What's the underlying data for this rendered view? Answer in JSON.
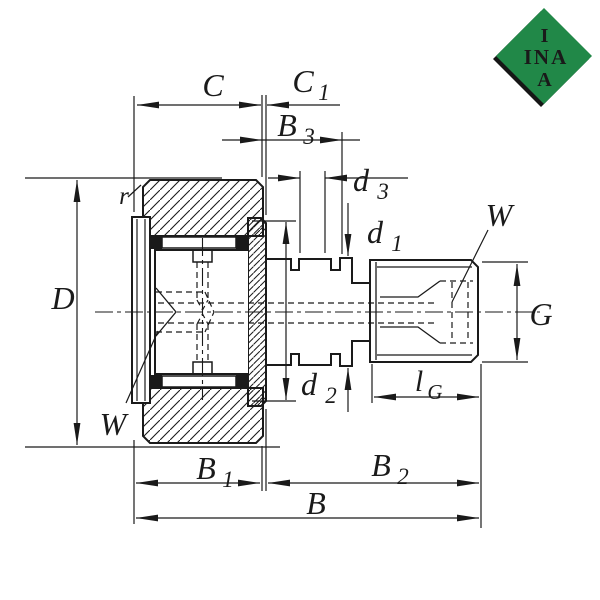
{
  "title": "Cam follower stud-type track roller dimension drawing",
  "logo": {
    "line1": "I",
    "line2": "INA",
    "line3": "A",
    "bg_color": "#218848",
    "shadow_color": "#161616",
    "text_color": "#ffffff"
  },
  "drawing": {
    "line_color": "#1a1a1a",
    "labels": {
      "C": {
        "main": "C"
      },
      "C1": {
        "main": "C",
        "sub": "1"
      },
      "B3": {
        "main": "B",
        "sub": "3"
      },
      "d3": {
        "main": "d",
        "sub": "3"
      },
      "d1": {
        "main": "d",
        "sub": "1"
      },
      "d2": {
        "main": "d",
        "sub": "2"
      },
      "r": {
        "main": "r"
      },
      "D": {
        "main": "D"
      },
      "W_left": {
        "main": "W"
      },
      "W_right": {
        "main": "W"
      },
      "G": {
        "main": "G"
      },
      "lG": {
        "main": "l",
        "sub": "G"
      },
      "B1": {
        "main": "B",
        "sub": "1"
      },
      "B2": {
        "main": "B",
        "sub": "2"
      },
      "B": {
        "main": "B"
      }
    }
  }
}
